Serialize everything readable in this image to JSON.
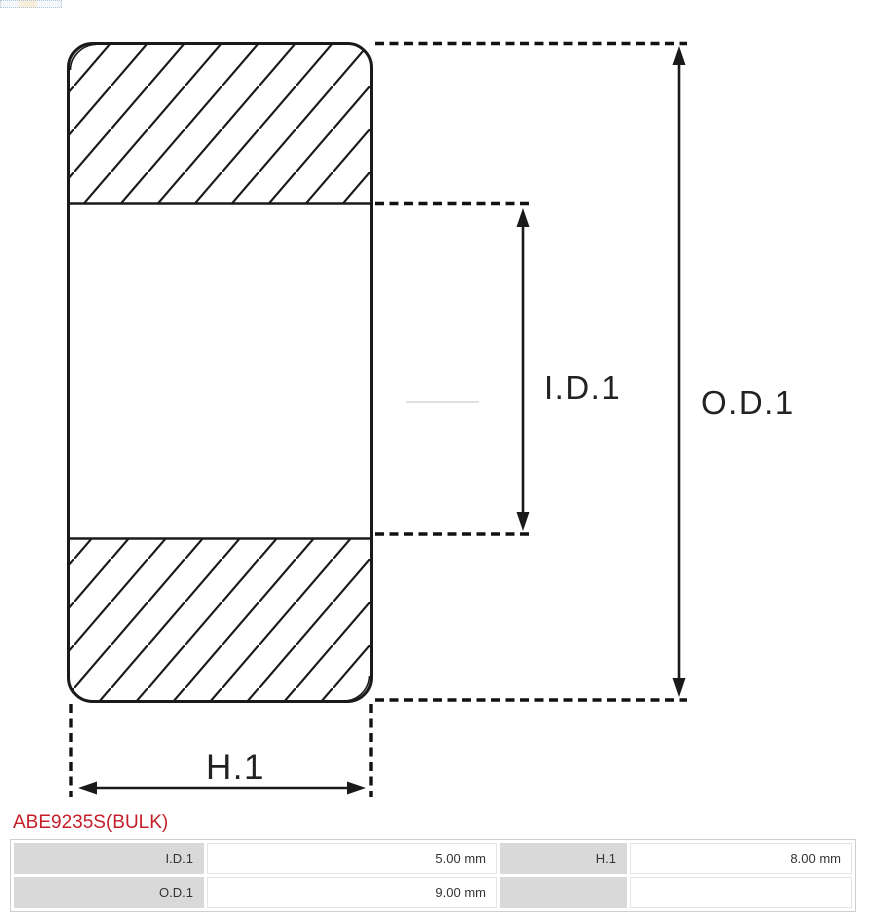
{
  "part": {
    "number": "ABE9235S(BULK)",
    "accent_color": "#c41e28"
  },
  "diagram": {
    "type": "bearing-cross-section",
    "labels": {
      "inner_diameter": "I.D.1",
      "outer_diameter": "O.D.1",
      "height": "H.1"
    },
    "colors": {
      "line": "#1a1a1a",
      "label_text": "#222222",
      "hatch": "#1a1a1a",
      "centerline": "#e0e0e0"
    }
  },
  "spec_table": {
    "label_cell_color": "#d9d9d9",
    "rows": [
      [
        "I.D.1",
        "5.00 mm",
        "H.1",
        "8.00 mm"
      ],
      [
        "O.D.1",
        "9.00 mm",
        "",
        ""
      ]
    ]
  }
}
